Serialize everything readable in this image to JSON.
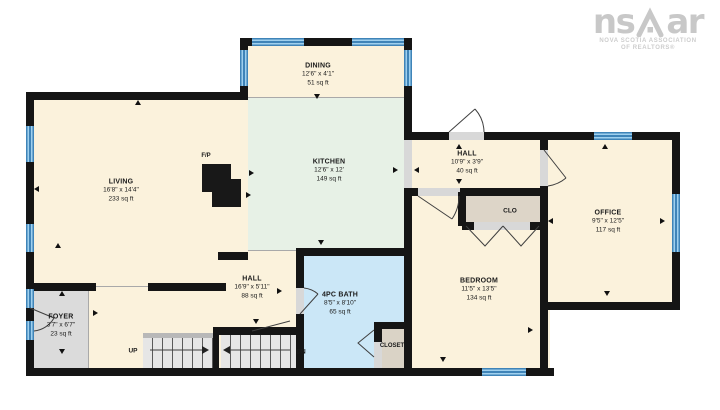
{
  "logo": {
    "text_left": "ns",
    "text_right": "ar",
    "subtitle_line1": "NOVA SCOTIA ASSOCIATION",
    "subtitle_line2": "OF REALTORS®"
  },
  "rooms": {
    "living": {
      "name": "LIVING",
      "dims": "16'8\" x 14'4\"",
      "area": "233 sq ft"
    },
    "dining": {
      "name": "DINING",
      "dims": "12'6\" x 4'1\"",
      "area": "51 sq ft"
    },
    "kitchen": {
      "name": "KITCHEN",
      "dims": "12'6\" x 12'",
      "area": "149 sq ft"
    },
    "hall_upper": {
      "name": "HALL",
      "dims": "10'9\" x 3'9\"",
      "area": "40 sq ft"
    },
    "office": {
      "name": "OFFICE",
      "dims": "9'5\" x 12'5\"",
      "area": "117 sq ft"
    },
    "bedroom": {
      "name": "BEDROOM",
      "dims": "11'5\" x 13'5\"",
      "area": "134 sq ft"
    },
    "hall_lower": {
      "name": "HALL",
      "dims": "16'9\" x 5'11\"",
      "area": "88 sq ft"
    },
    "bath": {
      "name": "4PC BATH",
      "dims": "8'5\" x 8'10\"",
      "area": "65 sq ft"
    },
    "foyer": {
      "name": "FOYER",
      "dims": "3'7\" x 6'7\"",
      "area": "23 sq ft"
    }
  },
  "labels": {
    "clo": "CLO",
    "closet": "CLOSET",
    "fireplace": "F/P",
    "stairs_up": "UP",
    "stairs_down": "DN"
  },
  "colors": {
    "wall_black": "#151515",
    "room_cream": "#fbf2dc",
    "kitchen_green": "#e7f1e6",
    "bath_blue": "#cbe7f7",
    "neutral_gray": "#dbdbdb",
    "window_blue": "#4d9dd4",
    "logo_gray": "#c8c8c8"
  }
}
